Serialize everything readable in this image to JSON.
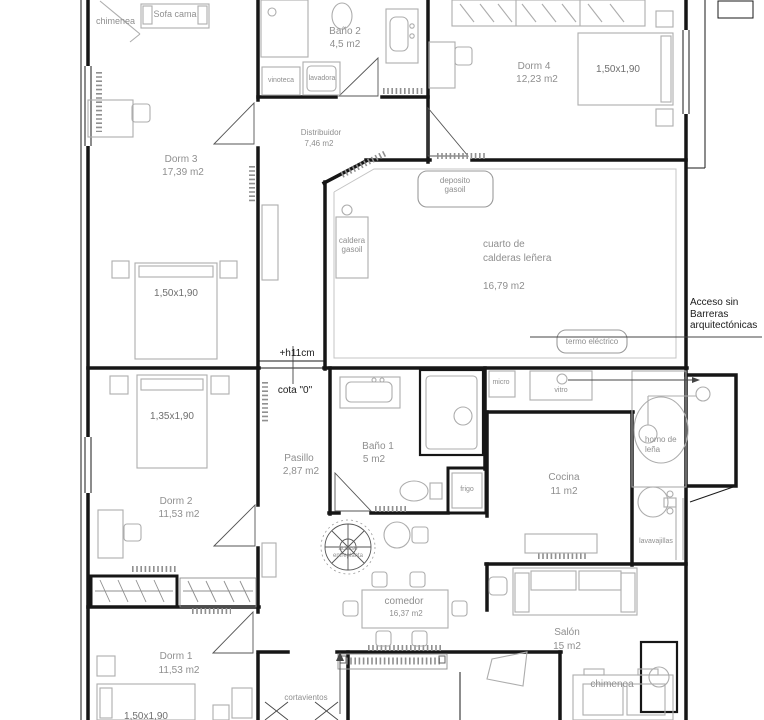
{
  "meta": {
    "drawing_type": "floor plan",
    "language": "es"
  },
  "colors": {
    "wall": "#161616",
    "furniture": "#adadad",
    "label_gray": "#8f8f8f",
    "label_dark": "#1b1b1b"
  },
  "rooms": [
    {
      "id": "dorm3",
      "name": "Dorm 3",
      "area": "17,39 m2"
    },
    {
      "id": "bano2",
      "name": "Baño 2",
      "area": "4,5 m2"
    },
    {
      "id": "dorm4",
      "name": "Dorm 4",
      "area": "12,23 m2"
    },
    {
      "id": "distribuidor",
      "name": "Distribuidor",
      "area": "7,46 m2"
    },
    {
      "id": "calderas",
      "name": "cuarto de calderas leñera",
      "area": "16,79 m2"
    },
    {
      "id": "dorm2",
      "name": "Dorm 2",
      "area": "11,53 m2"
    },
    {
      "id": "pasillo",
      "name": "Pasillo",
      "area": "2,87 m2"
    },
    {
      "id": "bano1",
      "name": "Baño 1",
      "area": "5 m2"
    },
    {
      "id": "cocina",
      "name": "Cocina",
      "area": "11 m2"
    },
    {
      "id": "comedor",
      "name": "comedor",
      "area": "16,37 m2"
    },
    {
      "id": "salon",
      "name": "Salón",
      "area": "15 m2"
    },
    {
      "id": "dorm1",
      "name": "Dorm 1",
      "area": "11,53 m2"
    }
  ],
  "fixtures": {
    "chimenea_top": "chimenea",
    "sofa_cama": "Sofa cama",
    "vinoteca": "vinoteca",
    "lavadora": "lavadora",
    "deposito_gasoil": "deposito gasoil",
    "caldera_gasoil": "caldera gasoil",
    "termo_electrico": "termo eléctrico",
    "micro": "micro",
    "vitro": "vitro",
    "frigo": "frigo",
    "horno_lena": "horno de leña",
    "lavavajillas": "lavavajillas",
    "escalera": "acceso entreplanta",
    "cortavientos": "cortavientos",
    "chimenea_salon": "chimenea"
  },
  "beds": {
    "dorm3": "1,50x1,90",
    "dorm4": "1,50x1,90",
    "dorm2": "1,35x1,90",
    "dorm1": "1,50x1,90"
  },
  "annotations": {
    "step": "+h11cm",
    "cota": "cota \"0\"",
    "acceso": "Acceso sin Barreras arquitectónicas"
  }
}
